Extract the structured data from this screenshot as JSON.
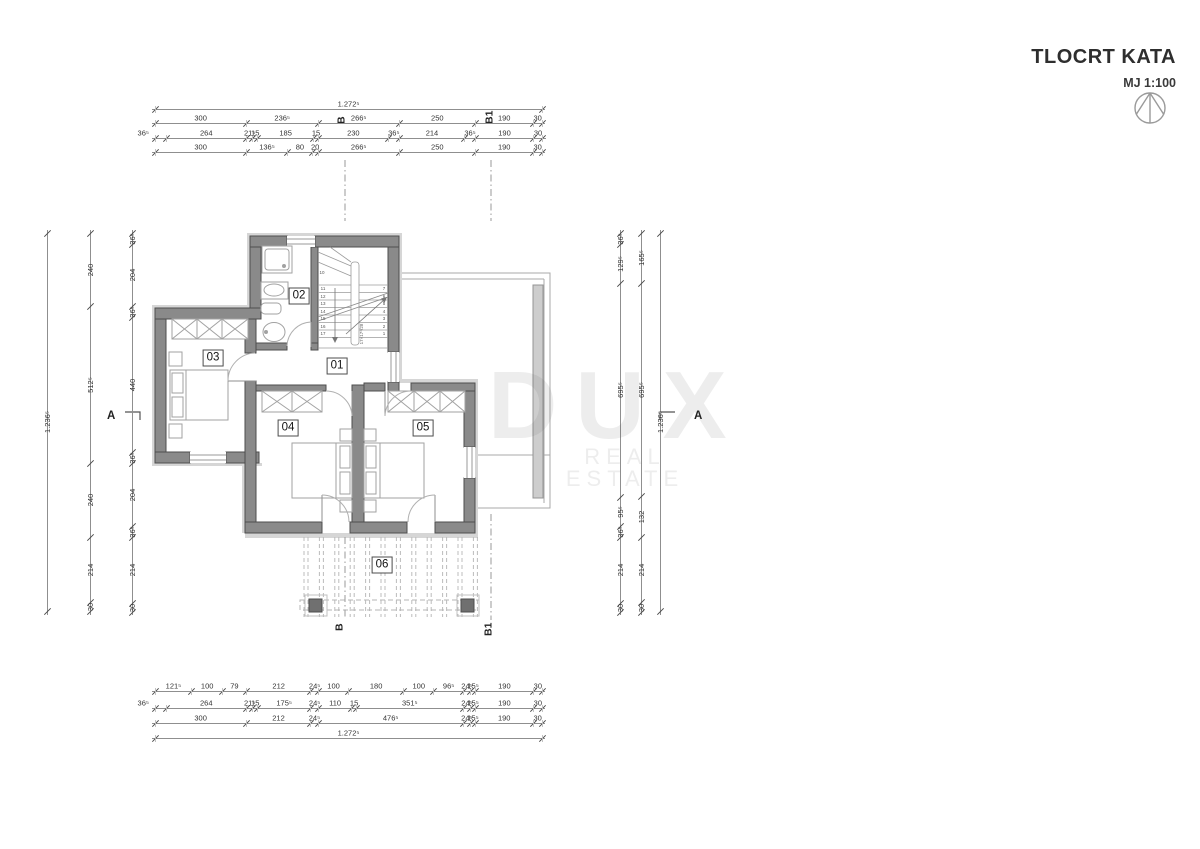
{
  "title": {
    "main": "TLOCRT KATA",
    "scale_label": "MJ 1:100"
  },
  "watermark": {
    "line1": "DUX",
    "line2": "REAL ESTATE"
  },
  "section_markers": {
    "a_left": "A",
    "a_right": "A",
    "b_top": "B",
    "b1_top": "B1",
    "b_bottom": "B",
    "b1_bottom": "B1"
  },
  "rooms": [
    {
      "id": "01",
      "x": 337,
      "y": 366
    },
    {
      "id": "02",
      "x": 299,
      "y": 296
    },
    {
      "id": "03",
      "x": 213,
      "y": 358
    },
    {
      "id": "04",
      "x": 288,
      "y": 428
    },
    {
      "id": "05",
      "x": 423,
      "y": 428
    },
    {
      "id": "06",
      "x": 382,
      "y": 565
    }
  ],
  "stairs": {
    "left_numbers": [
      "10",
      "11",
      "12",
      "13",
      "14",
      "15",
      "16",
      "17"
    ],
    "right_numbers": [
      "7",
      "6",
      "5",
      "4",
      "3",
      "2",
      "1"
    ],
    "annotation": "17×17⁶/28"
  },
  "dimensions": {
    "top": {
      "x0": 155,
      "rows": [
        {
          "y": 109,
          "segs": [
            {
              "label": "1.272⁵",
              "v": 1272.5
            }
          ]
        },
        {
          "y": 123,
          "segs": [
            {
              "label": "300",
              "v": 300
            },
            {
              "label": "236⁵",
              "v": 236.5
            },
            {
              "label": "266⁵",
              "v": 266.5
            },
            {
              "label": "250",
              "v": 250
            },
            {
              "label": "190",
              "v": 190
            },
            {
              "label": "30",
              "v": 30
            }
          ]
        },
        {
          "y": 138,
          "segs": [
            {
              "label": "36⁵",
              "v": 36.5,
              "out": true
            },
            {
              "label": "264",
              "v": 264
            },
            {
              "label": "21⁵",
              "v": 21.5
            },
            {
              "label": "15",
              "v": 15
            },
            {
              "label": "185",
              "v": 185
            },
            {
              "label": "15",
              "v": 15
            },
            {
              "label": "230",
              "v": 230
            },
            {
              "label": "36⁵",
              "v": 36.5
            },
            {
              "label": "214",
              "v": 214
            },
            {
              "label": "36⁵",
              "v": 36.5
            },
            {
              "label": "190",
              "v": 190
            },
            {
              "label": "30",
              "v": 30
            }
          ]
        },
        {
          "y": 152,
          "segs": [
            {
              "label": "300",
              "v": 300
            },
            {
              "label": "136⁵",
              "v": 136.5
            },
            {
              "label": "80",
              "v": 80
            },
            {
              "label": "20",
              "v": 20
            },
            {
              "label": "266⁵",
              "v": 266.5
            },
            {
              "label": "250",
              "v": 250
            },
            {
              "label": "190",
              "v": 190
            },
            {
              "label": "30",
              "v": 30
            }
          ]
        }
      ]
    },
    "bottom": {
      "x0": 155,
      "rows": [
        {
          "y": 691,
          "segs": [
            {
              "label": "121⁵",
              "v": 121.5
            },
            {
              "label": "100",
              "v": 100
            },
            {
              "label": "79",
              "v": 79
            },
            {
              "label": "212",
              "v": 212
            },
            {
              "label": "24⁵",
              "v": 24.5
            },
            {
              "label": "100",
              "v": 100
            },
            {
              "label": "180",
              "v": 180
            },
            {
              "label": "100",
              "v": 100
            },
            {
              "label": "96⁵",
              "v": 96.5
            },
            {
              "label": "24⁵",
              "v": 24.5
            },
            {
              "label": "15⁵",
              "v": 15.5
            },
            {
              "label": "190",
              "v": 190
            },
            {
              "label": "30",
              "v": 30
            }
          ]
        },
        {
          "y": 708,
          "segs": [
            {
              "label": "36⁵",
              "v": 36.5,
              "out": true
            },
            {
              "label": "264",
              "v": 264
            },
            {
              "label": "21⁵",
              "v": 21.5
            },
            {
              "label": "15",
              "v": 15
            },
            {
              "label": "175⁵",
              "v": 175.5
            },
            {
              "label": "24⁵",
              "v": 24.5
            },
            {
              "label": "110",
              "v": 110
            },
            {
              "label": "15",
              "v": 15
            },
            {
              "label": "351⁵",
              "v": 351.5
            },
            {
              "label": "24⁵",
              "v": 24.5
            },
            {
              "label": "15⁵",
              "v": 15.5
            },
            {
              "label": "190",
              "v": 190
            },
            {
              "label": "30",
              "v": 30
            }
          ]
        },
        {
          "y": 723,
          "segs": [
            {
              "label": "300",
              "v": 300
            },
            {
              "label": "212",
              "v": 212
            },
            {
              "label": "24⁵",
              "v": 24.5
            },
            {
              "label": "476⁵",
              "v": 476.5
            },
            {
              "label": "24⁵",
              "v": 24.5
            },
            {
              "label": "15⁵",
              "v": 15.5
            },
            {
              "label": "190",
              "v": 190
            },
            {
              "label": "30",
              "v": 30
            }
          ]
        },
        {
          "y": 738,
          "segs": [
            {
              "label": "1.272⁵",
              "v": 1272.5
            }
          ]
        }
      ]
    },
    "left": {
      "y0": 233,
      "cols": [
        {
          "x": 47,
          "segs": [
            {
              "label": "1.236⁵",
              "v": 1236.5
            }
          ]
        },
        {
          "x": 90,
          "segs": [
            {
              "label": "240",
              "v": 240
            },
            {
              "label": "512⁵",
              "v": 512.5
            },
            {
              "label": "240",
              "v": 240
            },
            {
              "label": "214",
              "v": 214
            },
            {
              "label": "30",
              "v": 30
            }
          ]
        },
        {
          "x": 132,
          "segs": [
            {
              "label": "36⁵",
              "v": 36.5
            },
            {
              "label": "204",
              "v": 204
            },
            {
              "label": "36⁵",
              "v": 36.5
            },
            {
              "label": "440",
              "v": 440
            },
            {
              "label": "36⁵",
              "v": 36.5
            },
            {
              "label": "204",
              "v": 204
            },
            {
              "label": "36⁵",
              "v": 36.5
            },
            {
              "label": "214",
              "v": 214
            },
            {
              "label": "30",
              "v": 30
            }
          ]
        }
      ]
    },
    "right": {
      "y0": 233,
      "cols": [
        {
          "x": 620,
          "segs": [
            {
              "label": "36⁵",
              "v": 36.5
            },
            {
              "label": "129⁵",
              "v": 129.5
            },
            {
              "label": "695⁵",
              "v": 695.5
            },
            {
              "label": "95⁵",
              "v": 95.5
            },
            {
              "label": "36⁵",
              "v": 36.5
            },
            {
              "label": "214",
              "v": 214
            },
            {
              "label": "30",
              "v": 30
            }
          ]
        },
        {
          "x": 641,
          "segs": [
            {
              "label": "165⁵",
              "v": 165.5
            },
            {
              "label": "695⁵",
              "v": 695.5
            },
            {
              "label": "132",
              "v": 132
            },
            {
              "label": "214",
              "v": 214
            },
            {
              "label": "30",
              "v": 30
            }
          ]
        },
        {
          "x": 660,
          "segs": [
            {
              "label": "1.236⁵",
              "v": 1236.5
            }
          ]
        }
      ]
    }
  }
}
